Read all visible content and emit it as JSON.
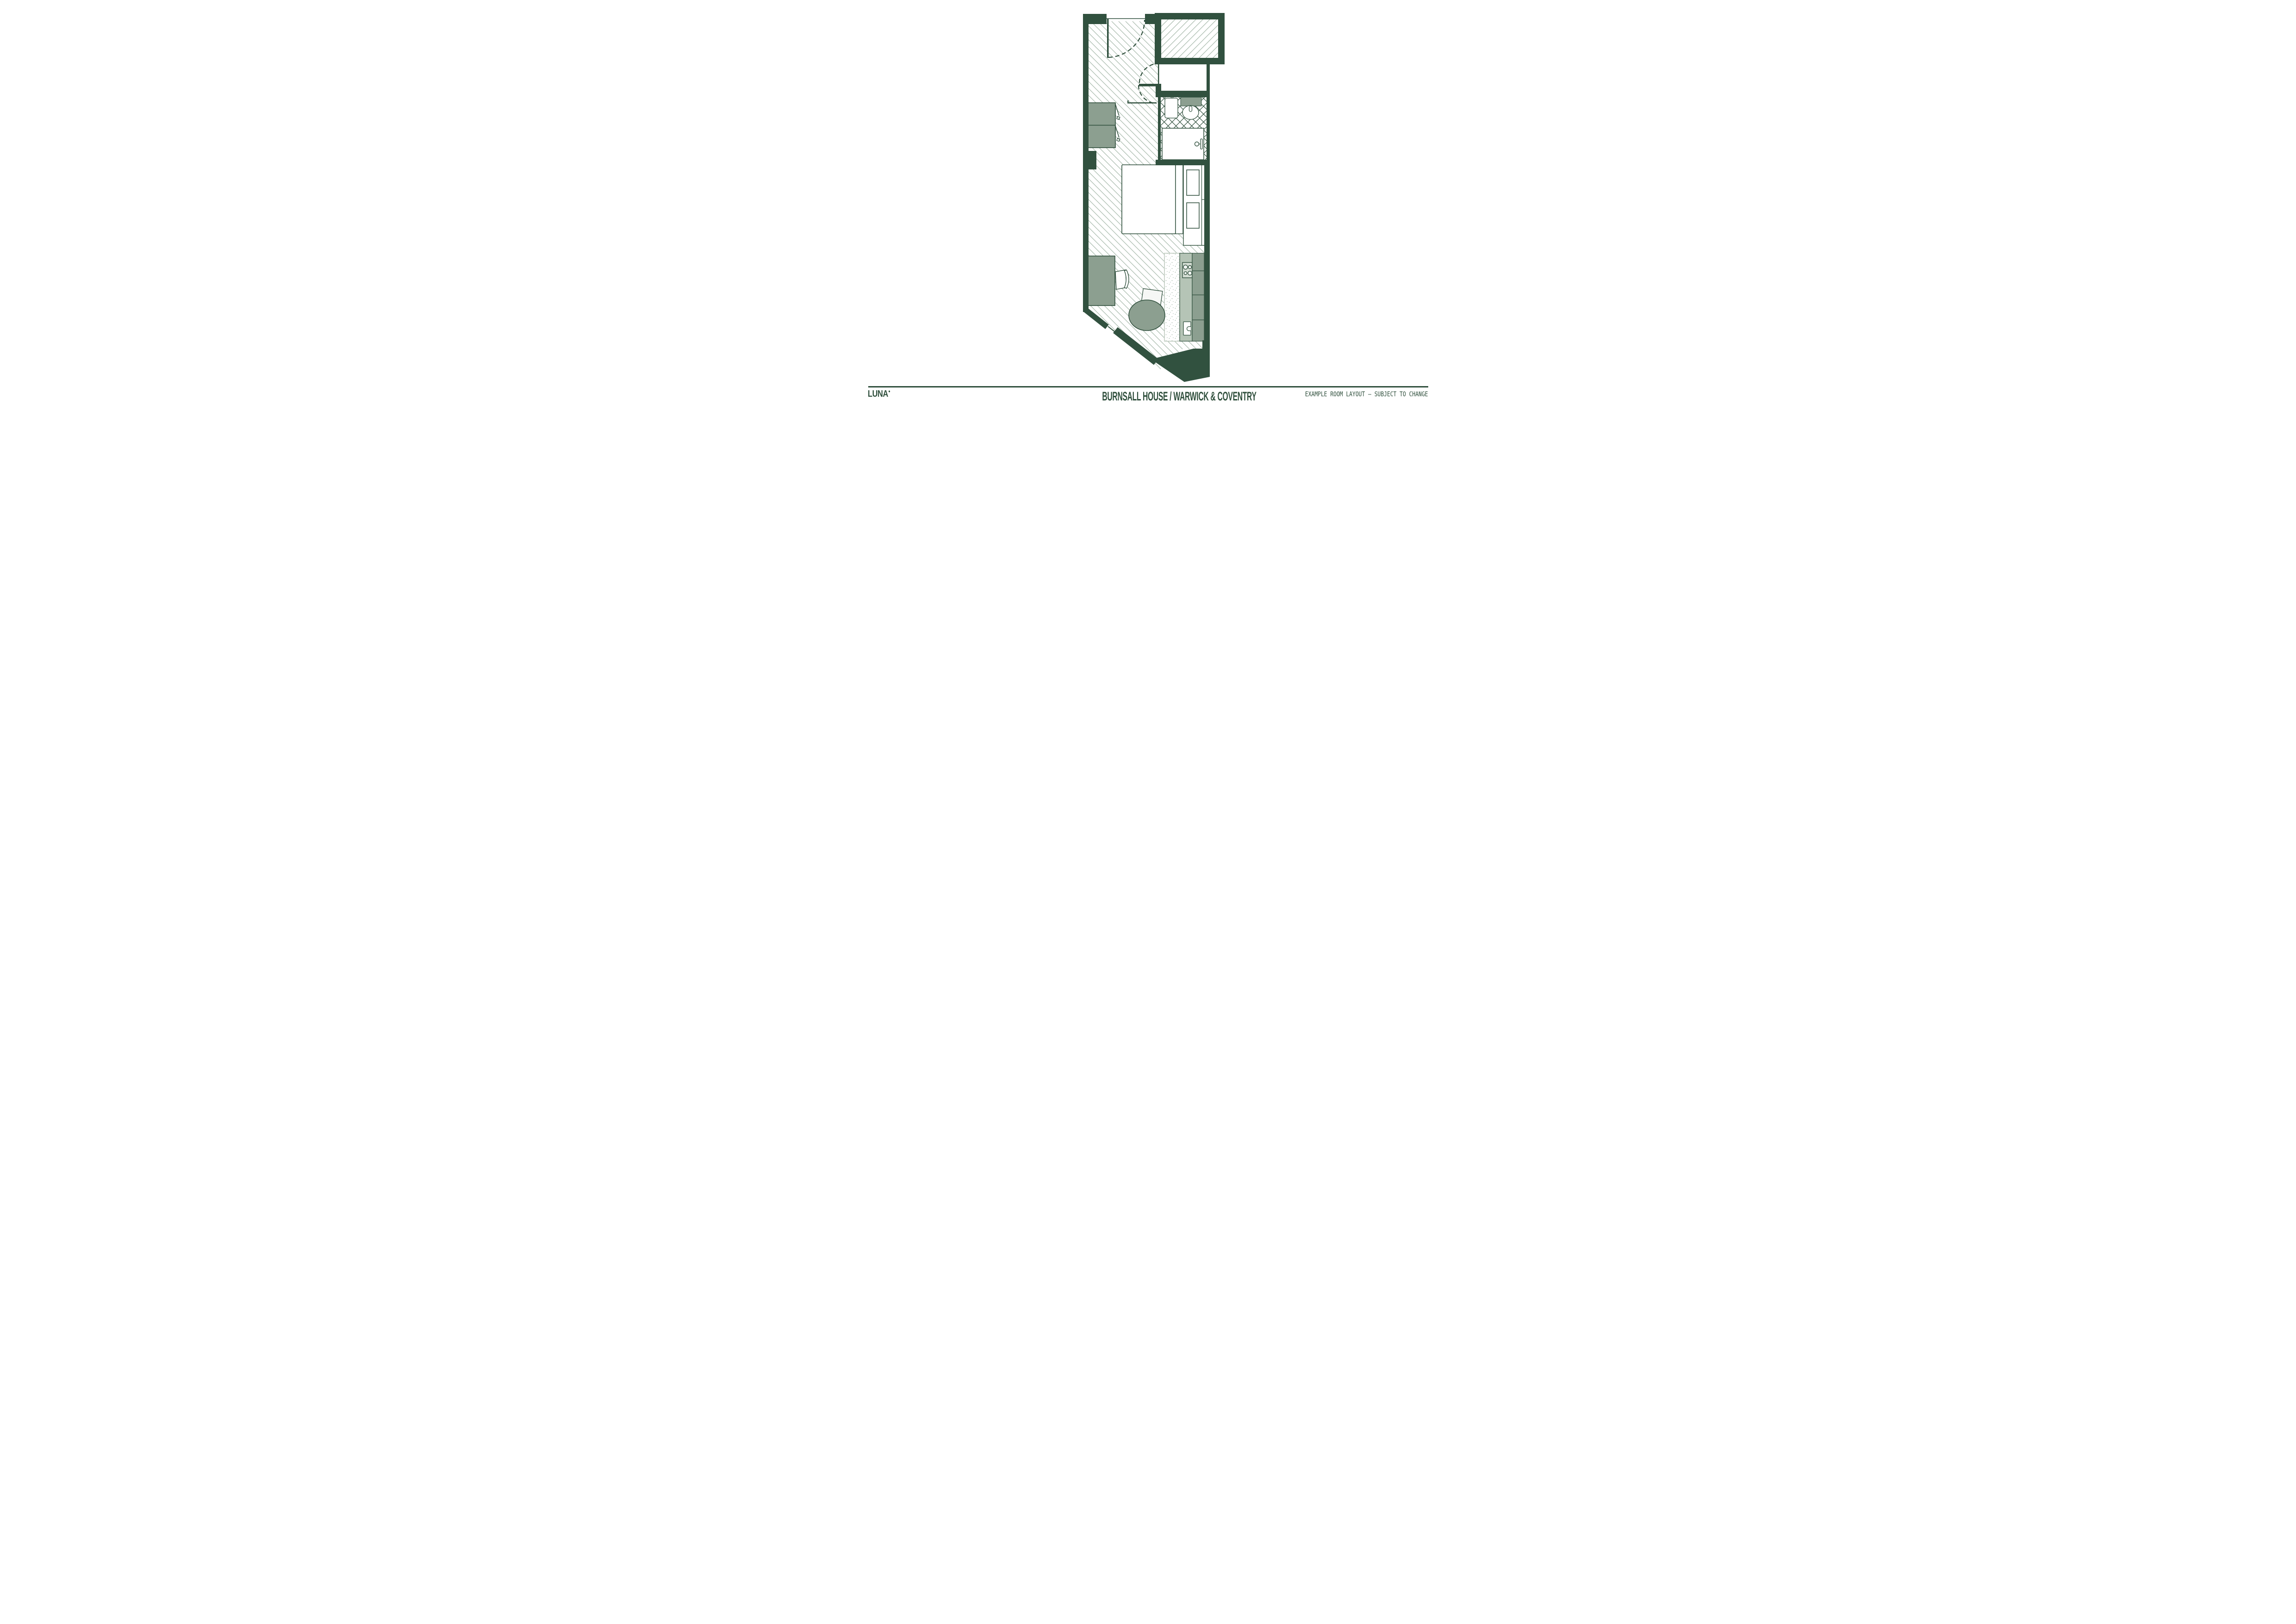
{
  "footer": {
    "brand": "LUNA",
    "brand_mark": "●",
    "title": "BURNSALL HOUSE / WARWICK & COVENTRY",
    "disclaimer": "EXAMPLE ROOM LAYOUT – SUBJECT TO CHANGE"
  },
  "palette": {
    "wall_green": "#31513F",
    "hatch_line": "#A9BBAD",
    "tile_line": "#2F4F3C",
    "furniture_sage": "#8C9F90",
    "counter_light": "#B5C4B6",
    "hob_grey": "#D3DCD2",
    "stipple_dot": "#9FB4A4",
    "paper": "#FFFFFF"
  },
  "plan": {
    "elements": [
      "entry-door",
      "door-swing-arc",
      "service-shaft",
      "utility-cupboard",
      "bathroom",
      "toilet",
      "basin-counter",
      "basin",
      "shower",
      "wardrobe",
      "wall-pier",
      "bed",
      "headboard",
      "shelf-drawer-unit",
      "desk",
      "desk-chair",
      "dining-chair",
      "round-table",
      "kitchen-mat",
      "kitchen-counter",
      "hob",
      "kitchen-sink",
      "kitchen-units",
      "window-glazing",
      "angled-wall"
    ]
  }
}
